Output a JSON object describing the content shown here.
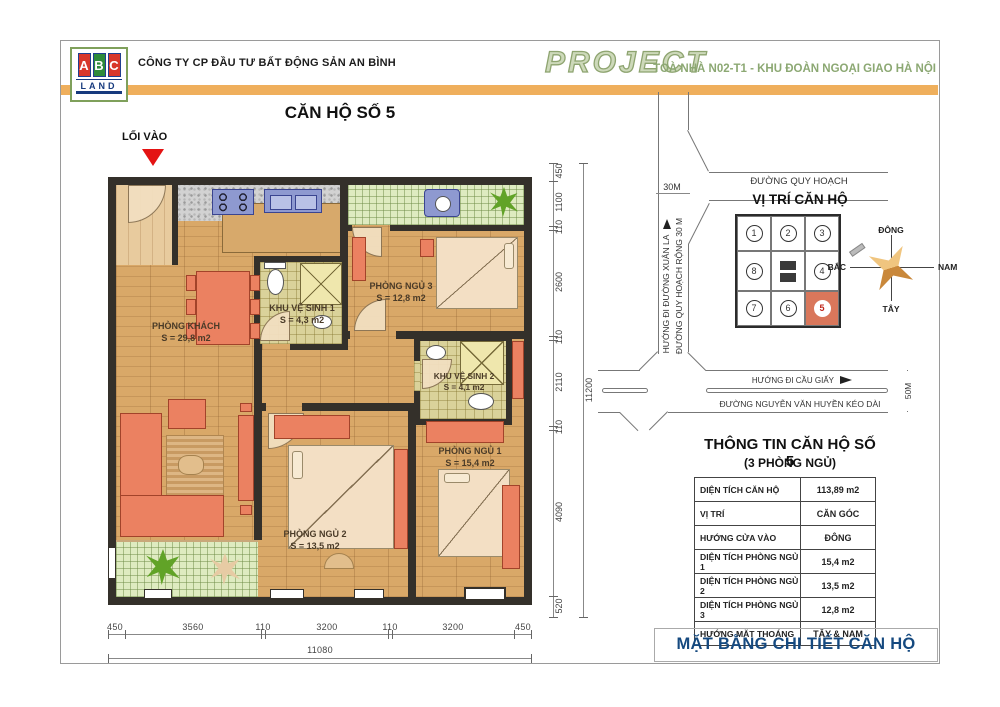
{
  "header": {
    "logo": {
      "letters": [
        "A",
        "B",
        "C"
      ],
      "land": "LAND"
    },
    "company": "CÔNG TY CP ĐẦU TƯ BẤT ĐỘNG SẢN AN BÌNH",
    "project": "PROJECT",
    "building": "TOÀ NHÀ N02-T1 - KHU ĐOÀN NGOẠI GIAO HÀ NỘI"
  },
  "plan": {
    "title": "CĂN HỘ SỐ 5",
    "entrance_label": "LỐI VÀO",
    "rooms": {
      "living": {
        "name": "PHÒNG KHÁCH",
        "area": "S = 29,8 m2"
      },
      "bath1": {
        "name": "KHU VỆ SINH 1",
        "area": "S = 4,3 m2"
      },
      "bed3": {
        "name": "PHÒNG NGỦ 3",
        "area": "S = 12,8 m2"
      },
      "bath2": {
        "name": "KHU VỆ SINH 2",
        "area": "S = 4,1 m2"
      },
      "bed1": {
        "name": "PHÒNG NGỦ 1",
        "area": "S = 15,4 m2"
      },
      "bed2": {
        "name": "PHÒNG NGỦ 2",
        "area": "S = 13,5 m2"
      }
    },
    "dims_bottom": [
      "450",
      "3560",
      "110",
      "3200",
      "110",
      "3200",
      "450"
    ],
    "dim_bottom_total": "11080",
    "dims_right": [
      "450",
      "1100",
      "110",
      "2600",
      "110",
      "2110",
      "110",
      "4090",
      "520"
    ],
    "dim_right_total": "11200"
  },
  "map": {
    "road_top": "ĐƯỜNG QUY HOẠCH",
    "title": "VỊ TRÍ CĂN HỘ",
    "road_left_width": "30M",
    "road_left_dir": "HƯỚNG ĐI ĐƯỜNG XUÂN LA",
    "road_left_name": "ĐƯỜNG QUY HOẠCH RỘNG 30 M",
    "road_bottom_dir": "HƯỚNG ĐI CẦU GIẤY",
    "road_bottom_name": "ĐƯỜNG NGUYỄN VĂN HUYỀN KÉO DÀI",
    "road_bottom_width": "50M",
    "units": [
      "1",
      "2",
      "3",
      "8",
      "4",
      "7",
      "6",
      "5"
    ],
    "compass": {
      "top": "ĐÔNG",
      "right": "NAM",
      "bottom": "TÂY",
      "left": "BẮC"
    }
  },
  "info": {
    "title": "THÔNG TIN CĂN HỘ SỐ 5",
    "subtitle": "(3 PHÒNG NGỦ)",
    "rows": [
      {
        "label": "DIỆN TÍCH CĂN HỘ",
        "value": "113,89 m2"
      },
      {
        "label": "VỊ TRÍ",
        "value": "CĂN GÓC"
      },
      {
        "label": "HƯỚNG CỬA VÀO",
        "value": "ĐÔNG"
      },
      {
        "label": "DIỆN TÍCH PHÒNG NGỦ 1",
        "value": "15,4 m2"
      },
      {
        "label": "DIỆN TÍCH PHÒNG NGỦ 2",
        "value": "13,5 m2"
      },
      {
        "label": "DIỆN TÍCH PHÒNG NGỦ 3",
        "value": "12,8 m2"
      },
      {
        "label": "HƯỚNG MẶT THOÁNG",
        "value": "TÂY & NAM"
      }
    ]
  },
  "footer_title": "MẶT BẰNG CHI TIẾT CĂN HỘ",
  "colors": {
    "accent_orange": "#EFAF5C",
    "accent_green": "#8CA873",
    "footer_blue": "#15497F",
    "highlight_unit": "#D9775B",
    "entrance_red": "#E41313"
  }
}
